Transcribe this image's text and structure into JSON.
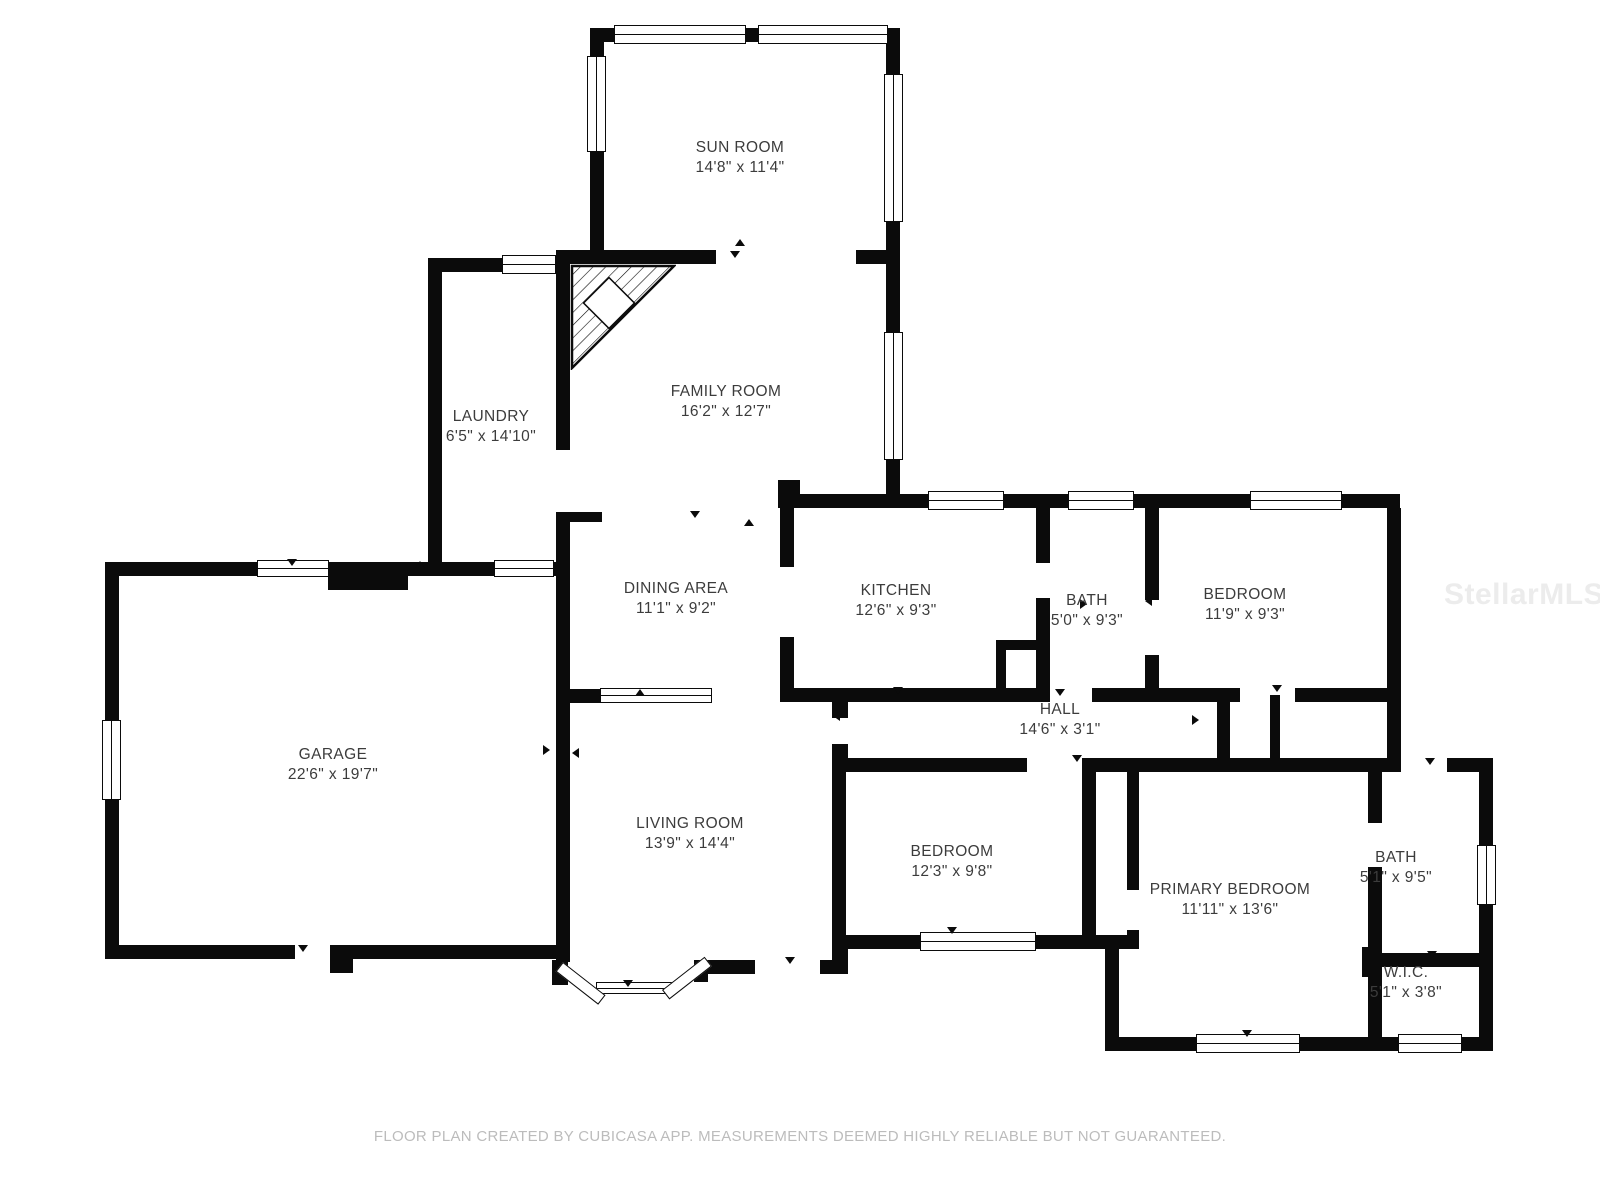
{
  "watermark": "StellarMLS",
  "footer": "FLOOR PLAN CREATED BY CUBICASA APP. MEASUREMENTS DEEMED HIGHLY RELIABLE BUT NOT GUARANTEED.",
  "colors": {
    "wall": "#0b0b0b",
    "background": "#ffffff",
    "label_text": "#3c3c3c",
    "footer_text": "#bcbcbc",
    "watermark_text": "#ececec"
  },
  "rooms": {
    "sun_room": {
      "name": "SUN ROOM",
      "dims": "14'8\" x 11'4\""
    },
    "family_room": {
      "name": "FAMILY ROOM",
      "dims": "16'2\" x 12'7\""
    },
    "laundry": {
      "name": "LAUNDRY",
      "dims": "6'5\" x 14'10\""
    },
    "dining_area": {
      "name": "DINING AREA",
      "dims": "11'1\" x 9'2\""
    },
    "kitchen": {
      "name": "KITCHEN",
      "dims": "12'6\" x 9'3\""
    },
    "bath_top": {
      "name": "BATH",
      "dims": "5'0\" x 9'3\""
    },
    "bedroom_top": {
      "name": "BEDROOM",
      "dims": "11'9\" x 9'3\""
    },
    "hall": {
      "name": "HALL",
      "dims": "14'6\" x 3'1\""
    },
    "garage": {
      "name": "GARAGE",
      "dims": "22'6\" x 19'7\""
    },
    "living_room": {
      "name": "LIVING ROOM",
      "dims": "13'9\" x 14'4\""
    },
    "bedroom_bottom": {
      "name": "BEDROOM",
      "dims": "12'3\" x 9'8\""
    },
    "primary_bedroom": {
      "name": "PRIMARY BEDROOM",
      "dims": "11'11\" x 13'6\""
    },
    "bath_bottom": {
      "name": "BATH",
      "dims": "5'1\" x 9'5\""
    },
    "wic": {
      "name": "W.I.C.",
      "dims": "5'1\" x 3'8\""
    }
  }
}
